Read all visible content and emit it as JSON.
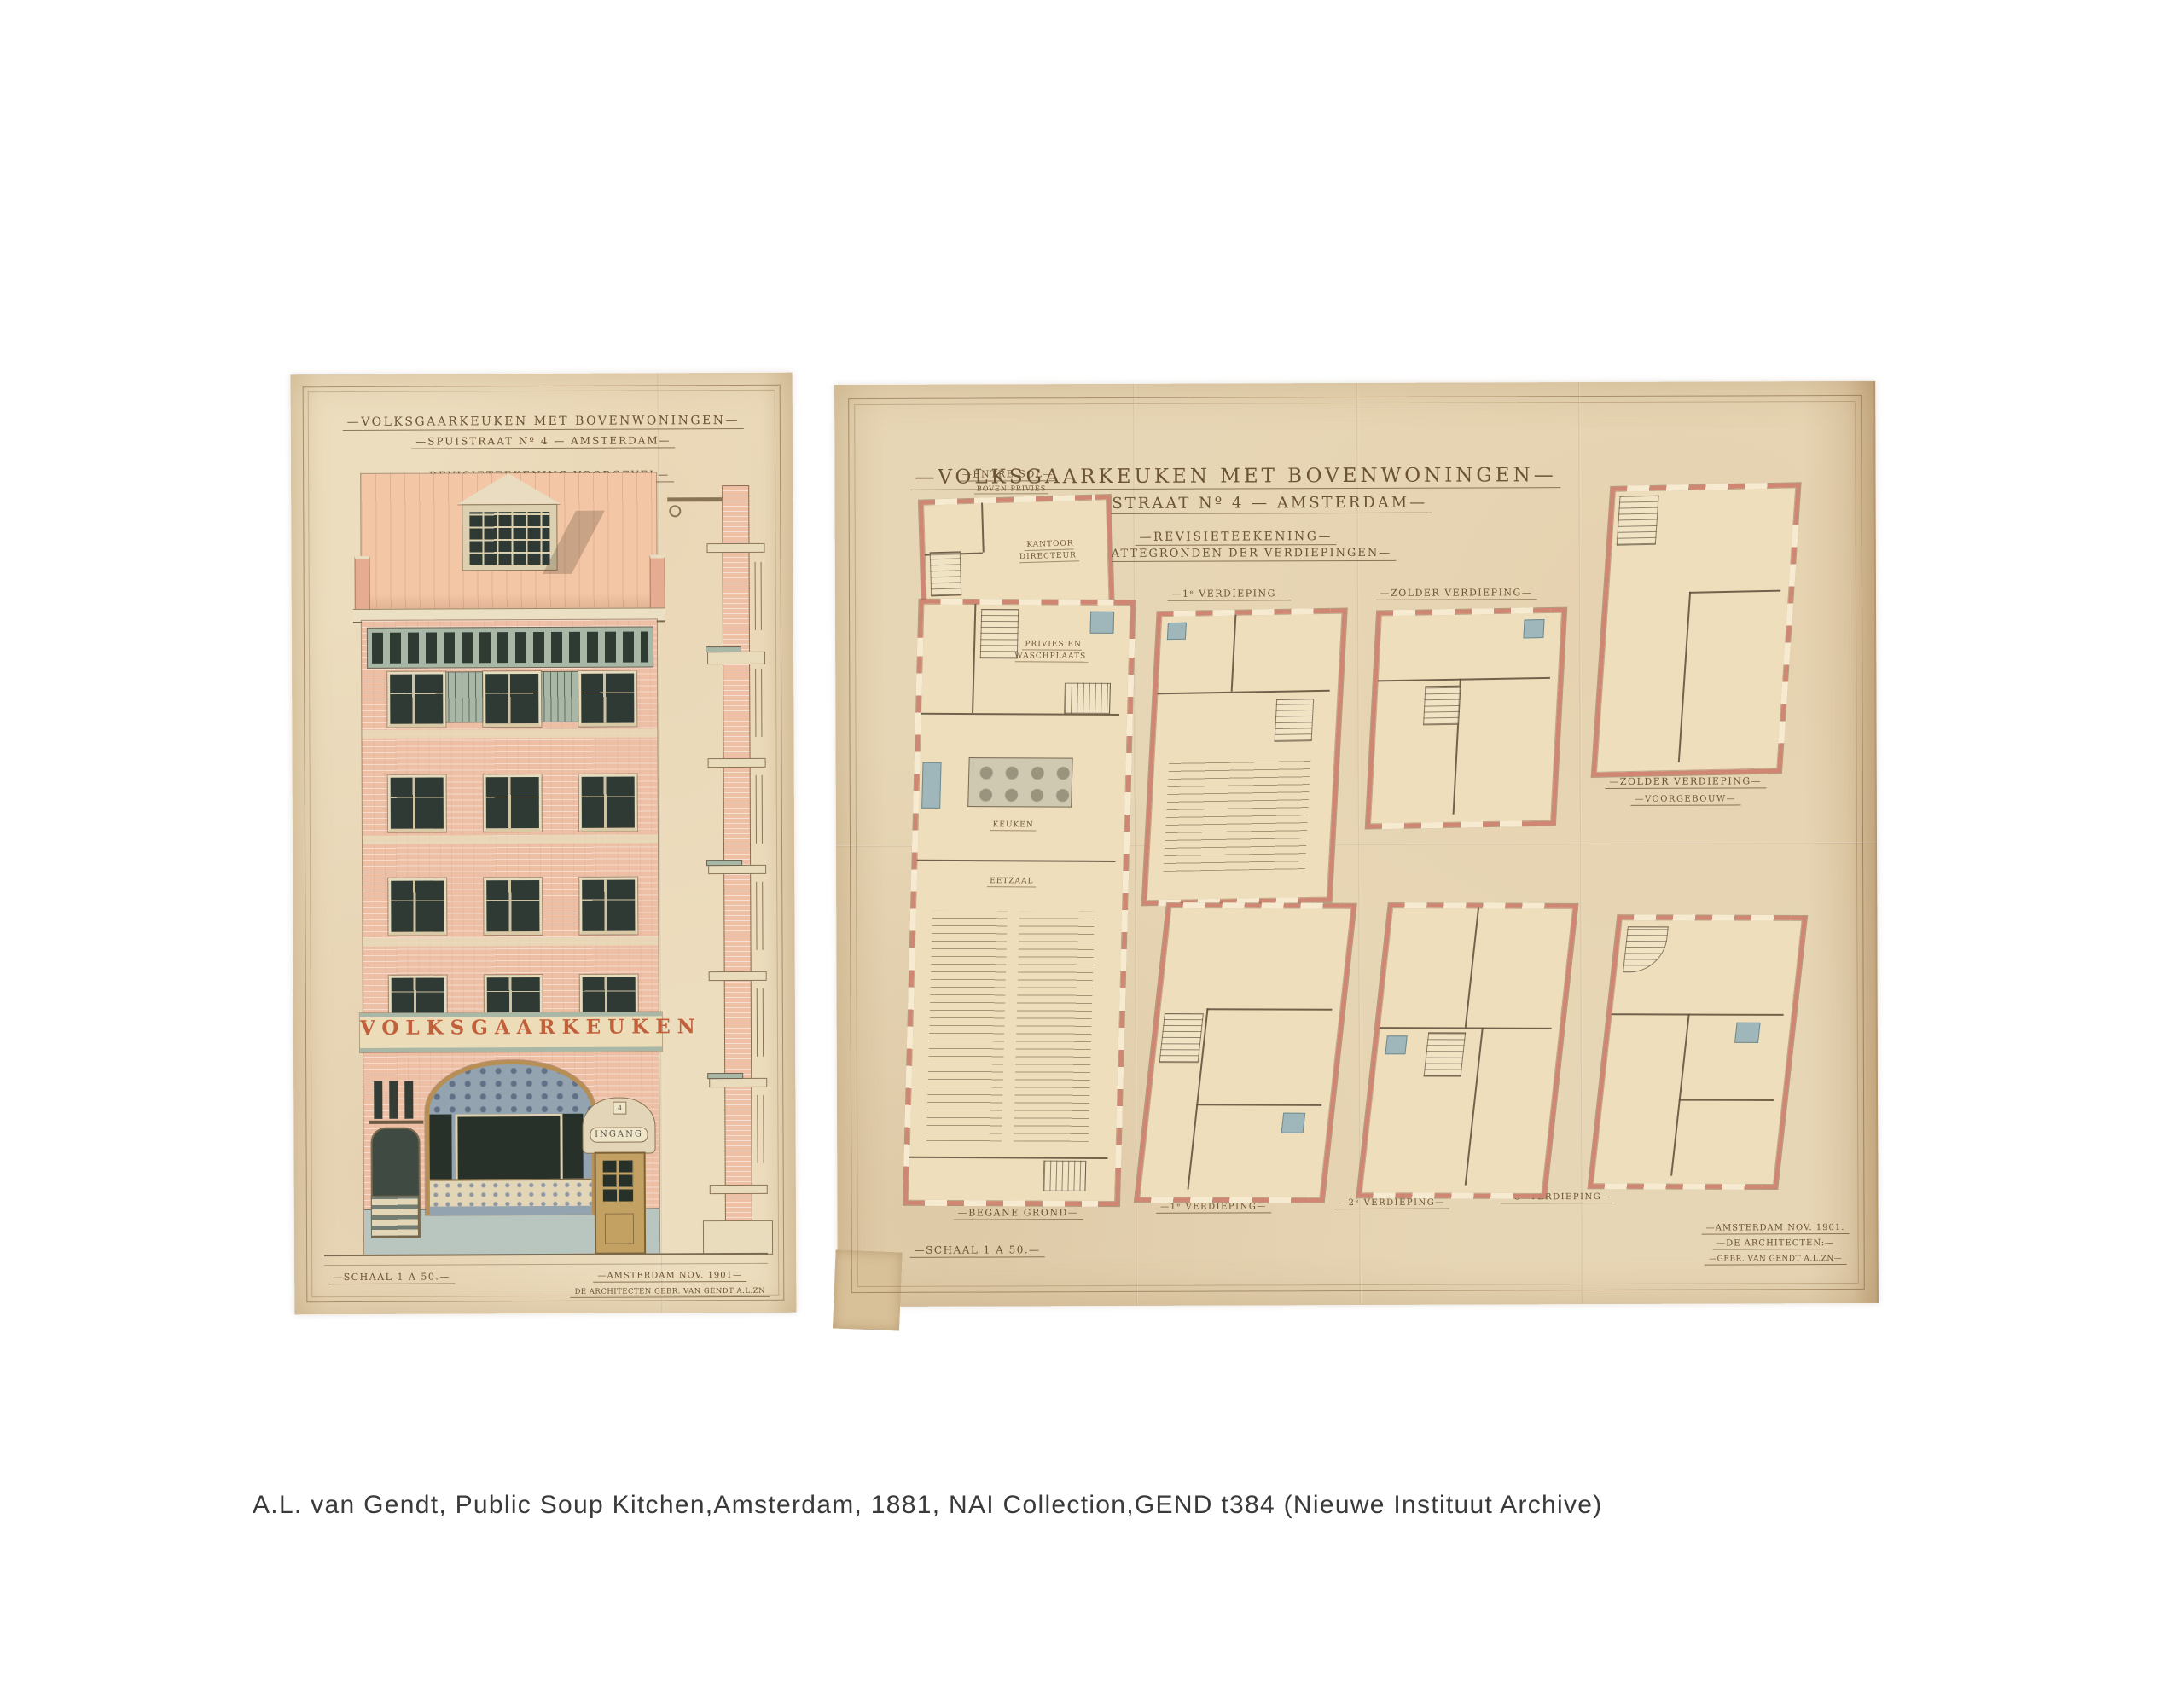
{
  "caption": "A.L. van Gendt, Public Soup Kitchen,Amsterdam, 1881, NAI Collection,GEND t384 (Nieuwe Instituut Archive)",
  "colors": {
    "paper_left": "#ecddbe",
    "paper_right": "#e7d6b5",
    "ink": "#6b5335",
    "plan_wall_red": "#cf8672",
    "brick_pink": "#edbfa5",
    "roof_salmon": "#f3c6a6",
    "trim_green": "#a9b7a6",
    "glass_dark": "#2e3a33",
    "wood": "#c2a163",
    "plinth_grey": "#b9c6bf",
    "banner_letters": "#c2603c",
    "fixture_blue": "#9fb6ba"
  },
  "elevation_sheet": {
    "title1": "—VOLKSGAARKEUKEN MET BOVENWONINGEN—",
    "title2": "—SPUISTRAAT Nº 4 — AMSTERDAM—",
    "title3": "—REVISIETEEKENING VOORGEVEL—",
    "banner": "VOLKSGAARKEUKEN",
    "entrance": "INGANG",
    "house_number": "4",
    "scale": "—SCHAAL 1 A 50.—",
    "sign1": "—AMSTERDAM NOV. 1901—",
    "sign2": "DE ARCHITECTEN GEBR. VAN GENDT A.L.ZN"
  },
  "plans_sheet": {
    "title1": "—VOLKSGAARKEUKEN MET BOVENWONINGEN—",
    "title2": "—SPUISTRAAT Nº 4 — AMSTERDAM—",
    "subtitle1": "—REVISIETEEKENING—",
    "subtitle2": "—PLATTEGRONDEN DER VERDIEPINGEN—",
    "scale": "—SCHAAL 1 A 50.—",
    "sign1": "—AMSTERDAM NOV. 1901.",
    "sign2": "—DE ARCHITECTEN:—",
    "sign3": "—GEBR. VAN GENDT A.L.ZN—",
    "labels": {
      "entresol": "—ENTRE SOL—",
      "entresol_sub": "BOVEN PRIVIES",
      "kantoor_directeur": "KANTOOR DIRECTEUR",
      "privies_waschplaats": "PRIVIES EN WASCHPLAATS",
      "keuken": "KEUKEN",
      "eetzaal": "EETZAAL",
      "begane_grond": "—BEGANE GROND—",
      "verd1_top": "—1ᵉ VERDIEPING—",
      "zolder_top": "—ZOLDER VERDIEPING—",
      "zolder_voorgebouw1": "—ZOLDER VERDIEPING—",
      "zolder_voorgebouw2": "—VOORGEBOUW—",
      "verd1_bottom": "—1ᵉ VERDIEPING—",
      "verd2_bottom": "—2ᵉ VERDIEPING—",
      "verd3_bottom": "—3ᵉ VERDIEPING—"
    }
  }
}
